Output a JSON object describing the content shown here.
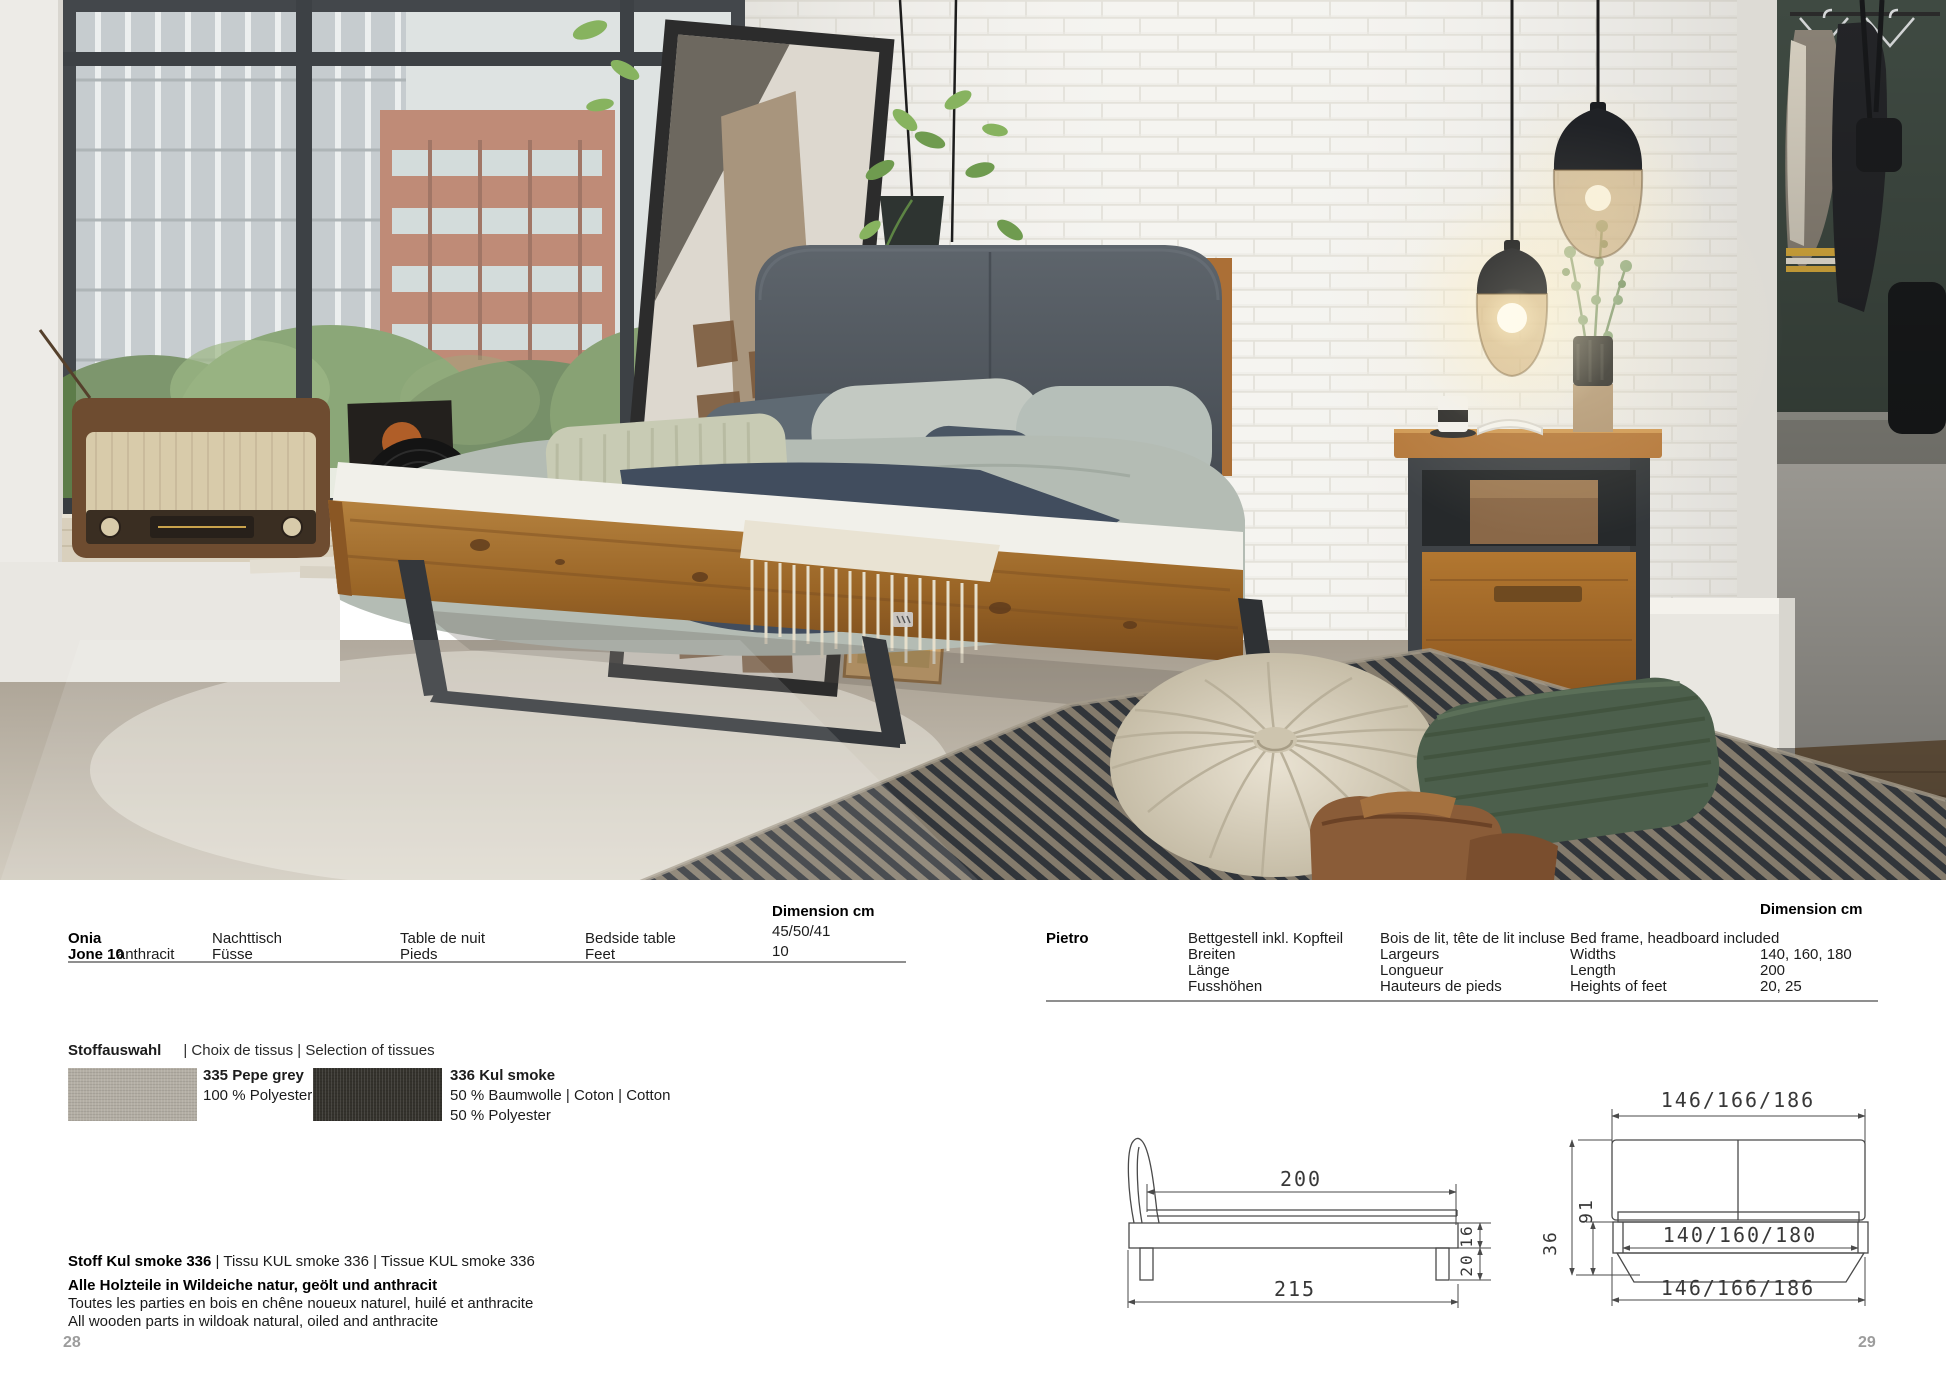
{
  "page": {
    "number_left": "28",
    "number_right": "29"
  },
  "spec_left": {
    "product": "Onia",
    "model": "Jone 10",
    "model_color": "anthracit",
    "col_de": [
      "Nachttisch",
      "Füsse"
    ],
    "col_fr": [
      "Table de nuit",
      "Pieds"
    ],
    "col_en": [
      "Bedside table",
      "Feet"
    ],
    "dimension_header": "Dimension cm",
    "dimension_values": [
      "45/50/41",
      "10"
    ]
  },
  "spec_right": {
    "product": "Pietro",
    "dimension_header": "Dimension cm",
    "rows": [
      {
        "de": "Bettgestell inkl. Kopfteil",
        "fr": "Bois de lit, tête de lit incluse",
        "en": "Bed frame, headboard included",
        "dim": ""
      },
      {
        "de": "Breiten",
        "fr": "Largeurs",
        "en": "Widths",
        "dim": "140, 160, 180"
      },
      {
        "de": "Länge",
        "fr": "Longueur",
        "en": "Length",
        "dim": "200"
      },
      {
        "de": "Fusshöhen",
        "fr": "Hauteurs de pieds",
        "en": "Heights of feet",
        "dim": "20, 25"
      }
    ]
  },
  "fabrics": {
    "title": "Stoffauswahl",
    "title_translations": "| Choix de tissus | Selection of tissues",
    "swatches": [
      {
        "name": "335 Pepe grey",
        "lines": [
          "100 % Polyester"
        ],
        "color": "#b3aea4"
      },
      {
        "name": "336 Kul smoke",
        "lines": [
          "50 % Baumwolle | Coton | Cotton",
          "50 % Polyester"
        ],
        "color": "#34322c"
      }
    ]
  },
  "materials": {
    "fabric_bold": "Stoff Kul smoke 336",
    "fabric_rest": " | Tissu KUL smoke 336 | Tissue KUL smoke 336",
    "wood_de": "Alle Holzteile in Wildeiche natur, geölt und anthracit",
    "wood_fr": "Toutes les parties en bois en chêne noueux naturel, huilé et anthracite",
    "wood_en": "All wooden parts in wildoak natural, oiled and anthracite"
  },
  "drawings": {
    "side": {
      "inner_length": "200",
      "outer_length": "215",
      "frame_height": "16",
      "foot_height": "20"
    },
    "front": {
      "outer_width_top": "146/166/186",
      "inner_width": "140/160/180",
      "outer_width_bottom": "146/166/186",
      "total_height": "36",
      "headboard_height": "91"
    }
  }
}
